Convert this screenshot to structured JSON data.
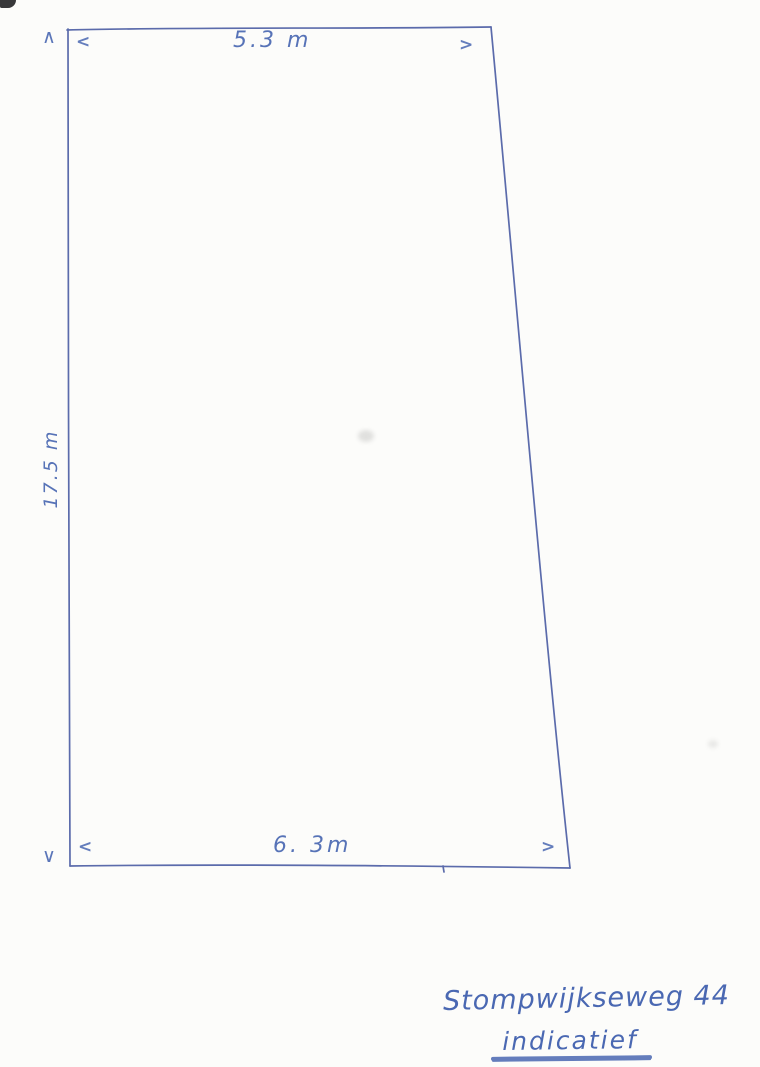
{
  "colors": {
    "paper": "#fcfcfa",
    "ink": "#4a68b2",
    "line": "#5b6bab"
  },
  "sketch": {
    "shape": "parcel-quadrilateral",
    "dim_top": "5.3 m",
    "dim_bottom": "6. 3m",
    "dim_left": "17.5 m",
    "arrow_up": "∧",
    "arrow_down": "∨",
    "arrow_open_top": "<",
    "arrow_close_top": ">",
    "arrow_open_bottom": "<",
    "arrow_close_bottom": ">"
  },
  "caption": {
    "address": "Stompwijkseweg 44",
    "note": "indicatief"
  }
}
